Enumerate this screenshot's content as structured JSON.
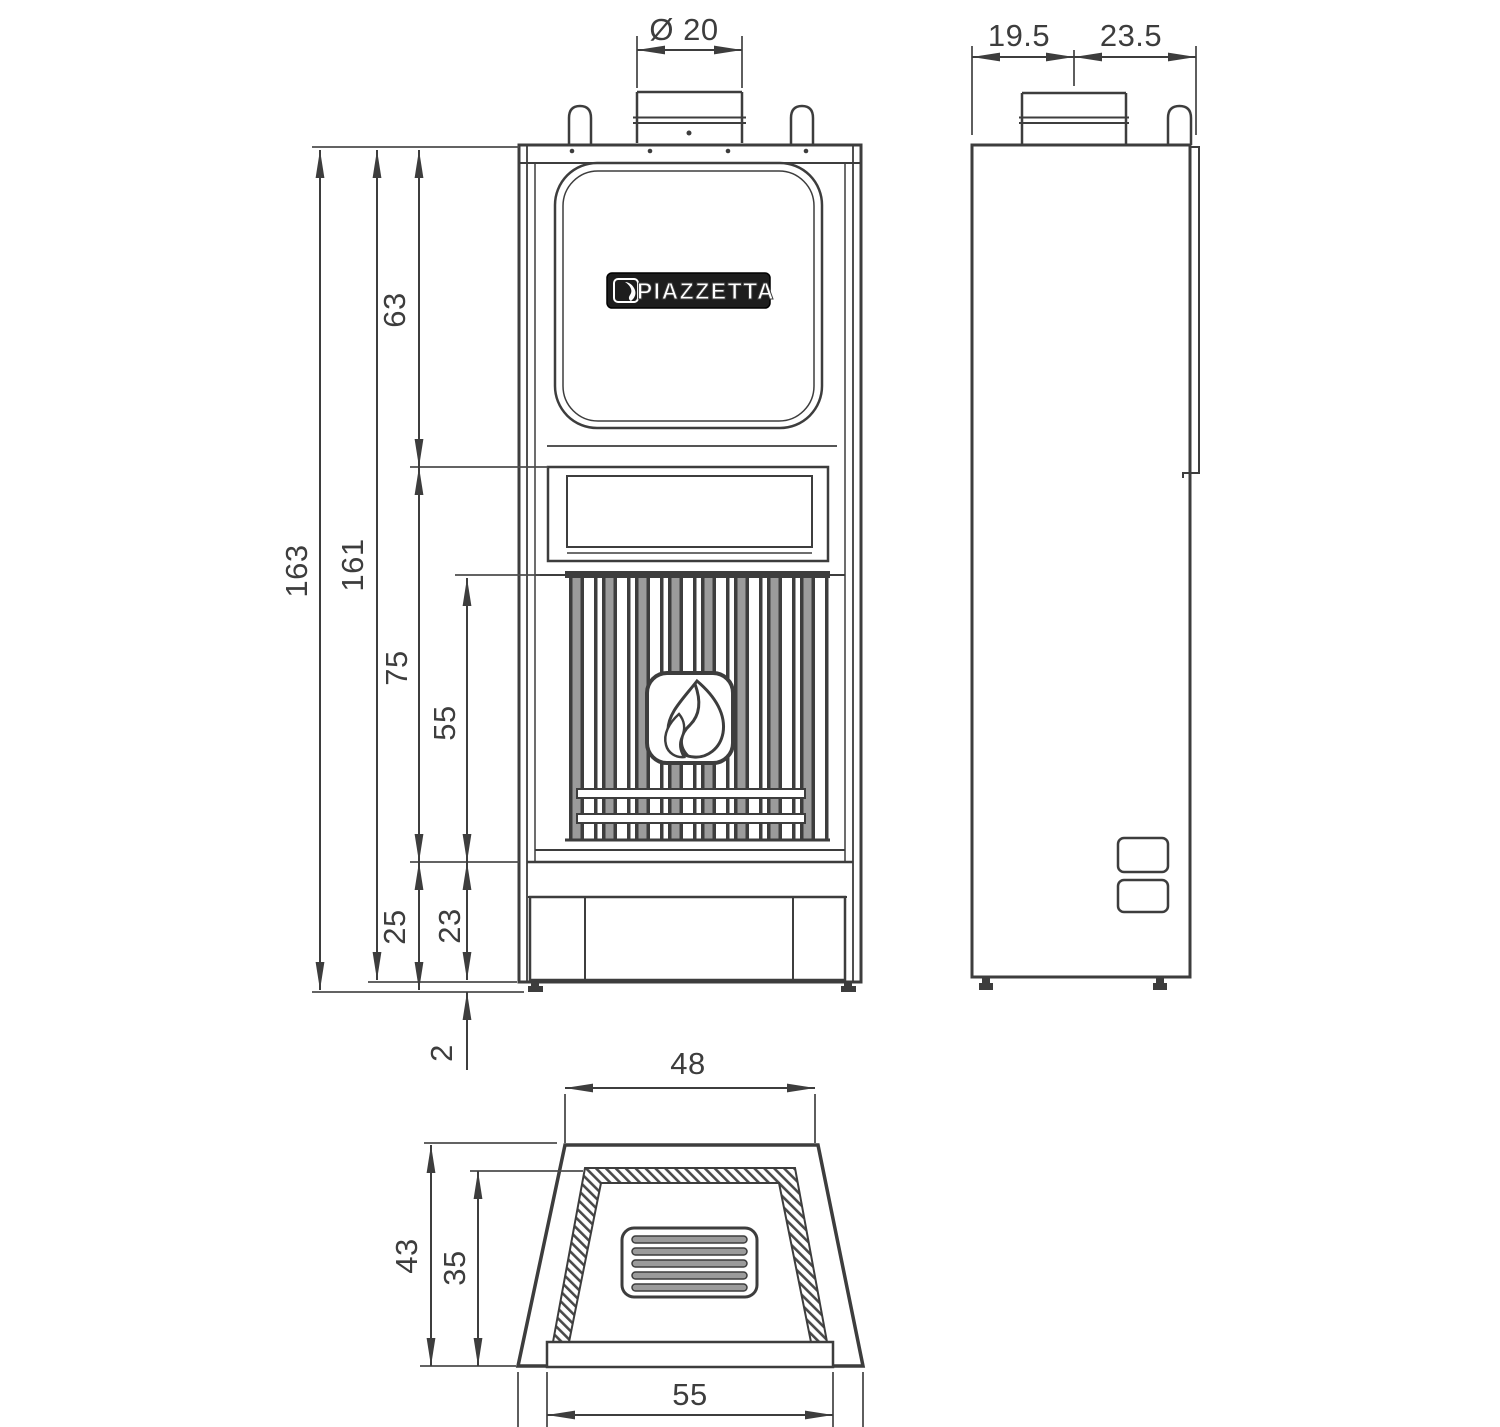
{
  "brand": {
    "logo_text": "PIAZZETTA"
  },
  "dims": {
    "front": {
      "flue_diameter": "Ø 20",
      "overall_height": "163",
      "body_height": "161",
      "upper_section_height": "63",
      "middle_section_height": "75",
      "firebox_height": "55",
      "plinth_with_feet_height": "25",
      "plinth_height": "23",
      "feet_clearance": "2"
    },
    "side": {
      "rear_to_flue_center": "19.5",
      "flue_center_to_front": "23.5"
    },
    "plan": {
      "top_width": "48",
      "overall_depth": "43",
      "inner_depth": "35",
      "base_width": "55"
    }
  },
  "colors": {
    "line": "#3d3d3d",
    "bar_gray": "#9b9b9b",
    "plate_black": "#1d1d1d"
  }
}
